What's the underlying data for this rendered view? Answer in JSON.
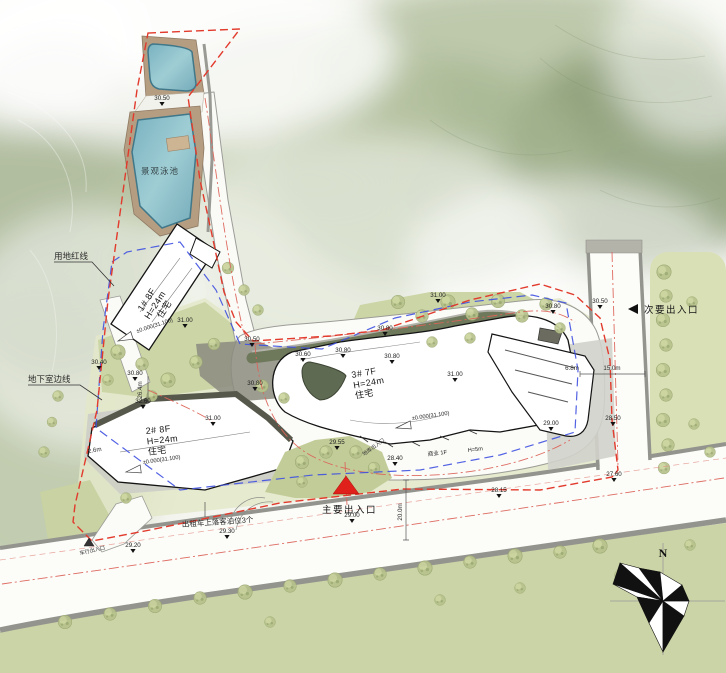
{
  "labels": {
    "pool": "景观泳池",
    "site_red_line": "用地红线",
    "basement_edge_line": "地下室边线",
    "secondary_entrance": "次要出入口",
    "main_entrance": "主要出入口",
    "taxi_bays": "出租车上落客泊位3个",
    "vehicle_entrance": "车行出入口",
    "garage_entrance": "地库出入口",
    "commercial": "商业 1F",
    "commercial_height": "H=5m",
    "north": "N"
  },
  "buildings": [
    {
      "name": "1#",
      "floors": "1#  8F",
      "height": "H=24m",
      "use": "住宅",
      "datum": "±0.000(31.100)"
    },
    {
      "name": "2#",
      "floors": "2#  8F",
      "height": "H=24m",
      "use": "住宅",
      "datum": "±0.000(31.100)"
    },
    {
      "name": "3#",
      "floors": "3#  7F",
      "height": "H=24m",
      "use": "住宅",
      "datum": "±0.000(31.100)"
    }
  ],
  "elevations": [
    {
      "value": "30.50"
    },
    {
      "value": "31.00"
    },
    {
      "value": "30.40"
    },
    {
      "value": "30.80"
    },
    {
      "value": "32.60"
    },
    {
      "value": "31.00"
    },
    {
      "value": "30.50"
    },
    {
      "value": "30.60"
    },
    {
      "value": "30.80"
    },
    {
      "value": "30.80"
    },
    {
      "value": "30.80"
    },
    {
      "value": "30.80"
    },
    {
      "value": "31.00"
    },
    {
      "value": "30.80"
    },
    {
      "value": "31.00"
    },
    {
      "value": "30.50"
    },
    {
      "value": "28.50"
    },
    {
      "value": "29.00"
    },
    {
      "value": "27.60"
    },
    {
      "value": "28.15"
    },
    {
      "value": "29.55"
    },
    {
      "value": "28.40"
    },
    {
      "value": "29.00"
    },
    {
      "value": "29.30"
    },
    {
      "value": "29.20"
    }
  ],
  "dimensions": [
    {
      "value": "26.4m"
    },
    {
      "value": "6.8m"
    },
    {
      "value": "15.0m"
    },
    {
      "value": "20.0m"
    },
    {
      "value": "2.6m"
    }
  ],
  "colors": {
    "boundary_red": "#e23a2c",
    "basement_blue": "#3f51e0",
    "pool_blue": "#8ec2cc",
    "entrance_red": "#e0201a"
  }
}
